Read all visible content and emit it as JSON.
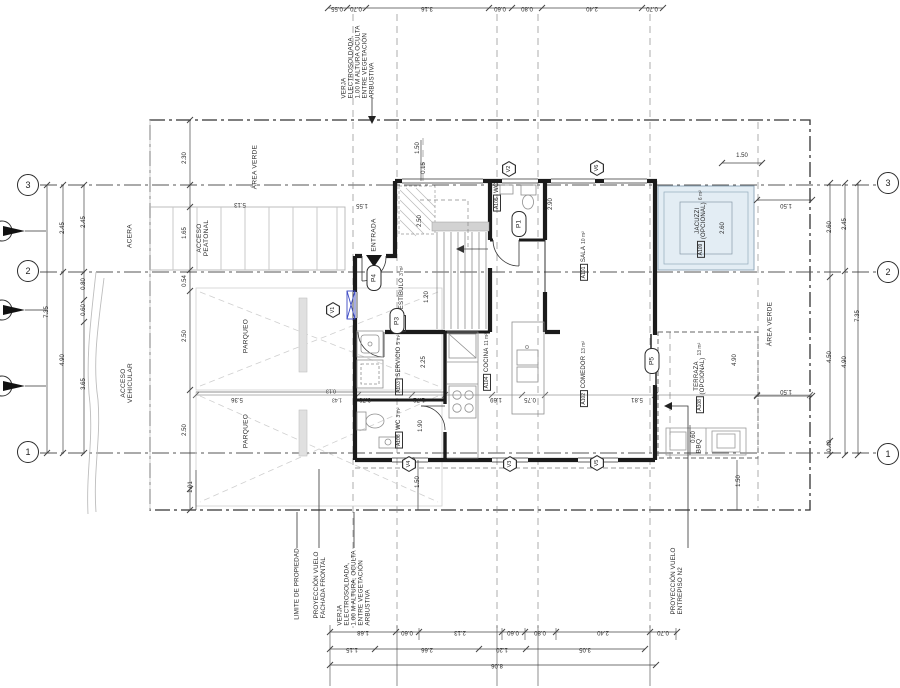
{
  "plan_title": "Planta arquitectónica - Nivel 1",
  "colors": {
    "wall": "#1b1b1b",
    "line": "#444444",
    "gray": "#9a9a9a",
    "light": "#c9c9c9",
    "blue": "#3b49c4",
    "jacuzzi_fill": "#e3edf4",
    "jacuzzi_line": "#93aabd"
  },
  "grid_bubbles": [
    {
      "label": "3",
      "x": 28,
      "y": 185
    },
    {
      "label": "2",
      "x": 28,
      "y": 271
    },
    {
      "label": "1",
      "x": 28,
      "y": 452
    },
    {
      "label": "3",
      "x": 888,
      "y": 183
    },
    {
      "label": "2",
      "x": 888,
      "y": 272
    },
    {
      "label": "1",
      "x": 888,
      "y": 454
    }
  ],
  "rooms": [
    {
      "tag": "A101",
      "name": "SALA",
      "area": "10 m²",
      "x": 584,
      "y": 256
    },
    {
      "tag": "A102",
      "name": "COMEDOR",
      "area": "13 m²",
      "x": 584,
      "y": 374
    },
    {
      "tag": "A103",
      "name": "SERVICIO",
      "area": "5 m²",
      "x": 399,
      "y": 365
    },
    {
      "tag": "A104",
      "name": "COCINA",
      "area": "11 m²",
      "x": 487,
      "y": 362
    },
    {
      "tag": "A105",
      "name": "WC",
      "area": "",
      "x": 497,
      "y": 197
    },
    {
      "tag": "A106",
      "name": "WC",
      "area": "3 m²",
      "x": 399,
      "y": 428
    },
    {
      "tag": "A107",
      "name": "VESTÍBULO",
      "area": "3 m²",
      "x": 402,
      "y": 299
    },
    {
      "tag": "A108",
      "name": "TERRAZA",
      "name2": "(OPCIONAL)",
      "area": "13 m²",
      "x": 700,
      "y": 378
    },
    {
      "tag": "A109",
      "name": "JACUZZI",
      "name2": "(OPCIONAL)",
      "area": "6 m²",
      "x": 701,
      "y": 224
    }
  ],
  "doors": [
    {
      "tag": "P1",
      "x": 519,
      "y": 224
    },
    {
      "tag": "P3",
      "x": 397,
      "y": 321
    },
    {
      "tag": "P4",
      "x": 374,
      "y": 278
    },
    {
      "tag": "P5",
      "x": 652,
      "y": 361
    }
  ],
  "windows": [
    {
      "tag": "V1",
      "x": 333,
      "y": 310
    },
    {
      "tag": "V2",
      "x": 509,
      "y": 169
    },
    {
      "tag": "V6",
      "x": 597,
      "y": 168
    },
    {
      "tag": "V4",
      "x": 409,
      "y": 464
    },
    {
      "tag": "V3",
      "x": 510,
      "y": 464
    },
    {
      "tag": "V5",
      "x": 597,
      "y": 463
    }
  ],
  "dims": [
    {
      "t": "0.55",
      "x": 337,
      "y": 8,
      "r": 180
    },
    {
      "t": "0.70",
      "x": 356,
      "y": 8,
      "r": 180
    },
    {
      "t": "3.16",
      "x": 427,
      "y": 8,
      "r": 180
    },
    {
      "t": "0.60",
      "x": 500,
      "y": 8,
      "r": 180
    },
    {
      "t": "0.80",
      "x": 527,
      "y": 8,
      "r": 180
    },
    {
      "t": "2.40",
      "x": 592,
      "y": 8,
      "r": 180
    },
    {
      "t": "0.70",
      "x": 652,
      "y": 8,
      "r": 180
    },
    {
      "t": "1.68",
      "x": 363,
      "y": 632,
      "r": 180
    },
    {
      "t": "0.60",
      "x": 407,
      "y": 632,
      "r": 180
    },
    {
      "t": "2.13",
      "x": 460,
      "y": 632,
      "r": 180
    },
    {
      "t": "0.60",
      "x": 513,
      "y": 632,
      "r": 180
    },
    {
      "t": "0.80",
      "x": 540,
      "y": 632,
      "r": 180
    },
    {
      "t": "2.40",
      "x": 603,
      "y": 632,
      "r": 180
    },
    {
      "t": "0.70",
      "x": 663,
      "y": 632,
      "r": 180
    },
    {
      "t": "1.15",
      "x": 352,
      "y": 649,
      "r": 180
    },
    {
      "t": "2.66",
      "x": 427,
      "y": 649,
      "r": 180
    },
    {
      "t": "1.20",
      "x": 502,
      "y": 649,
      "r": 180
    },
    {
      "t": "3.05",
      "x": 585,
      "y": 649,
      "r": 180
    },
    {
      "t": "8.06",
      "x": 497,
      "y": 665,
      "r": 180
    },
    {
      "t": "7.35",
      "x": 47,
      "y": 312,
      "r": 90
    },
    {
      "t": "2.45",
      "x": 63,
      "y": 228,
      "r": 90
    },
    {
      "t": "4.90",
      "x": 63,
      "y": 360,
      "r": 90
    },
    {
      "t": "2.45",
      "x": 84,
      "y": 222,
      "r": 90
    },
    {
      "t": "0.80",
      "x": 84,
      "y": 284,
      "r": 90
    },
    {
      "t": "0.60",
      "x": 84,
      "y": 310,
      "r": 90
    },
    {
      "t": "3.65",
      "x": 84,
      "y": 384,
      "r": 90
    },
    {
      "t": "2.60",
      "x": 830,
      "y": 227,
      "r": 90
    },
    {
      "t": "4.50",
      "x": 830,
      "y": 357,
      "r": 90
    },
    {
      "t": "0.40",
      "x": 830,
      "y": 446,
      "r": 90
    },
    {
      "t": "2.45",
      "x": 845,
      "y": 224,
      "r": 90
    },
    {
      "t": "4.90",
      "x": 845,
      "y": 362,
      "r": 90
    },
    {
      "t": "7.35",
      "x": 858,
      "y": 316,
      "r": 90
    },
    {
      "t": "2.30",
      "x": 185,
      "y": 158,
      "r": 90
    },
    {
      "t": "1.65",
      "x": 185,
      "y": 233,
      "r": 90
    },
    {
      "t": "0.54",
      "x": 185,
      "y": 281,
      "r": 90
    },
    {
      "t": "2.50",
      "x": 185,
      "y": 336,
      "r": 90
    },
    {
      "t": "2.50",
      "x": 185,
      "y": 430,
      "r": 90
    },
    {
      "t": "1.01",
      "x": 191,
      "y": 487,
      "r": 90
    },
    {
      "t": "5.13",
      "x": 240,
      "y": 204,
      "r": 180
    },
    {
      "t": "1.55",
      "x": 362,
      "y": 205,
      "r": 180
    },
    {
      "t": "1.50",
      "x": 418,
      "y": 148,
      "r": 90
    },
    {
      "t": "0.15",
      "x": 424,
      "y": 168,
      "r": 90
    },
    {
      "t": "2.50",
      "x": 420,
      "y": 221,
      "r": 90
    },
    {
      "t": "2.90",
      "x": 551,
      "y": 204,
      "r": 90
    },
    {
      "t": "1.20",
      "x": 427,
      "y": 297,
      "r": 90
    },
    {
      "t": "2.25",
      "x": 424,
      "y": 362,
      "r": 90
    },
    {
      "t": "1.90",
      "x": 421,
      "y": 426,
      "r": 90
    },
    {
      "t": "0.15",
      "x": 414,
      "y": 463,
      "r": 90
    },
    {
      "t": "1.50",
      "x": 418,
      "y": 482,
      "r": 90
    },
    {
      "t": "1.50",
      "x": 739,
      "y": 481,
      "r": 90
    },
    {
      "t": "2.60",
      "x": 723,
      "y": 228,
      "r": 90
    },
    {
      "t": "4.90",
      "x": 735,
      "y": 360,
      "r": 90
    },
    {
      "t": "0.60",
      "x": 694,
      "y": 437,
      "r": 90
    },
    {
      "t": "1.50",
      "x": 742,
      "y": 156,
      "r": 0
    },
    {
      "t": "5.36",
      "x": 237,
      "y": 399,
      "r": 180
    },
    {
      "t": "0.13",
      "x": 331,
      "y": 390,
      "r": 180,
      "s": 5
    },
    {
      "t": "1.43",
      "x": 337,
      "y": 399,
      "r": 180,
      "s": 5
    },
    {
      "t": "0.70",
      "x": 365,
      "y": 399,
      "r": 180
    },
    {
      "t": "1.72",
      "x": 419,
      "y": 399,
      "r": 180
    },
    {
      "t": "1.69",
      "x": 496,
      "y": 399,
      "r": 180
    },
    {
      "t": "0.75",
      "x": 530,
      "y": 399,
      "r": 180
    },
    {
      "t": "5.81",
      "x": 637,
      "y": 399,
      "r": 180
    },
    {
      "t": "1.50",
      "x": 786,
      "y": 205,
      "r": 180
    },
    {
      "t": "1.50",
      "x": 786,
      "y": 391,
      "r": 180
    }
  ],
  "site_labels": [
    {
      "lines": [
        "ACERA"
      ],
      "x": 131,
      "y": 236
    },
    {
      "lines": [
        "ACCESO",
        "VEHICULAR"
      ],
      "x": 128,
      "y": 383
    },
    {
      "lines": [
        "ÁREA VERDE"
      ],
      "x": 256,
      "y": 167
    },
    {
      "lines": [
        "ACCESO",
        "PEATONAL"
      ],
      "x": 204,
      "y": 238
    },
    {
      "lines": [
        "PARQUEO"
      ],
      "x": 247,
      "y": 336
    },
    {
      "lines": [
        "PARQUEO"
      ],
      "x": 247,
      "y": 431
    },
    {
      "lines": [
        "ÁREA VERDE"
      ],
      "x": 771,
      "y": 324
    },
    {
      "lines": [
        "ENTRADA"
      ],
      "x": 375,
      "y": 235
    },
    {
      "lines": [
        "BBQ"
      ],
      "x": 700,
      "y": 446
    }
  ],
  "annotations": [
    {
      "lines": [
        "VERJA",
        "ELECTROSOLDADA,",
        "1.00 M ALTURA OCULTA",
        "ENTRE VEGETACIÓN",
        "ARBUSTIVA"
      ],
      "x": 358,
      "y": 62
    },
    {
      "lines": [
        "LIMITE DE PROPIEDAD"
      ],
      "x": 297,
      "y": 584
    },
    {
      "lines": [
        "PROYECCIÓN VUELO",
        "FACHADA FRONTAL"
      ],
      "x": 320,
      "y": 585
    },
    {
      "lines": [
        "VERJA",
        "ELECTROSOLDADA,",
        "1.00 M ALTURA, OCULTA",
        "ENTRE VEGETACIÓN",
        "ARBUSTIVA"
      ],
      "x": 354,
      "y": 588
    },
    {
      "lines": [
        "PROYECCIÓN VUELO",
        "ENTREPISO N2"
      ],
      "x": 677,
      "y": 581
    }
  ]
}
